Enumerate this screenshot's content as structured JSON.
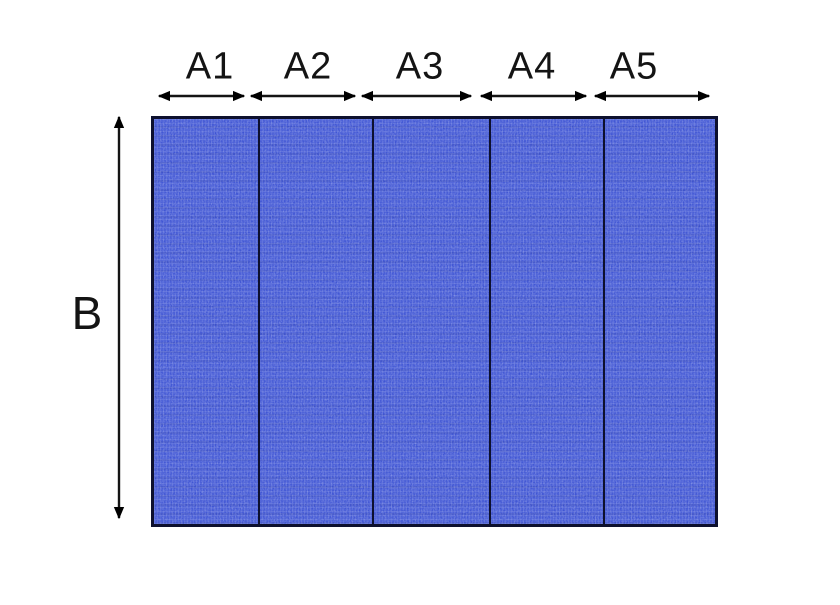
{
  "dimensions": {
    "top": [
      "A1",
      "A2",
      "A3",
      "A4",
      "A5"
    ],
    "side": "B"
  },
  "panel": {
    "section_count": 5
  },
  "colors": {
    "background": "#ffffff",
    "panel_fill": "#3e54d4",
    "panel_texture_highlight": "#6070e2",
    "panel_border": "#0d102e",
    "divider": "#0d102e",
    "arrow": "#141414",
    "label_text": "#141414"
  }
}
